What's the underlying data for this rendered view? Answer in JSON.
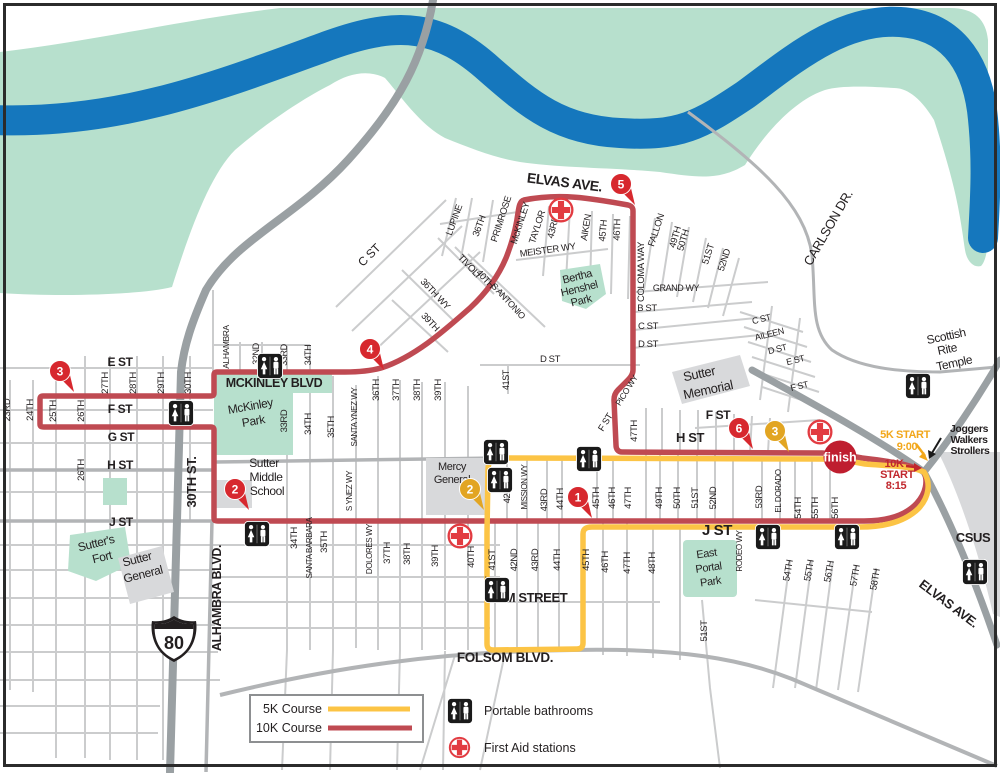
{
  "colors": {
    "river": "#1577bd",
    "riverbank": "#b7e0cd",
    "park": "#b7e0cd",
    "freeway": "#9aa0a3",
    "street": "#cbcccd",
    "street_medium": "#b2b4b6",
    "building": "#d8d9db",
    "course_5k": "#fcc445",
    "course_10k": "#bf4a52",
    "pin_red": "#d7282e",
    "pin_yellow": "#e2a522",
    "first_aid": "#e23b41",
    "finish_bg": "#bf1e2f",
    "start_5k_text": "#f2a71b",
    "start_10k_text": "#c1272d",
    "label": "#231f20"
  },
  "legend": {
    "course_5k": "5K Course",
    "course_10k": "10K Course",
    "bathrooms": "Portable bathrooms",
    "first_aid": "First Aid stations"
  },
  "finish": {
    "label": "finish"
  },
  "shield": {
    "number": "80"
  },
  "pins": [
    {
      "n": "1",
      "x": 578,
      "y": 497,
      "color": "red"
    },
    {
      "n": "2",
      "x": 235,
      "y": 489,
      "color": "red"
    },
    {
      "n": "3",
      "x": 60,
      "y": 371,
      "color": "red"
    },
    {
      "n": "4",
      "x": 370,
      "y": 349,
      "color": "red"
    },
    {
      "n": "5",
      "x": 621,
      "y": 184,
      "color": "red"
    },
    {
      "n": "6",
      "x": 739,
      "y": 428,
      "color": "red"
    },
    {
      "n": "2",
      "x": 470,
      "y": 489,
      "color": "yellow"
    },
    {
      "n": "3",
      "x": 775,
      "y": 431,
      "color": "yellow"
    }
  ],
  "restrooms": [
    {
      "x": 270,
      "y": 366
    },
    {
      "x": 181,
      "y": 413
    },
    {
      "x": 257,
      "y": 534
    },
    {
      "x": 496,
      "y": 452
    },
    {
      "x": 500,
      "y": 480
    },
    {
      "x": 589,
      "y": 459
    },
    {
      "x": 497,
      "y": 590
    },
    {
      "x": 768,
      "y": 537
    },
    {
      "x": 847,
      "y": 537
    },
    {
      "x": 918,
      "y": 386
    },
    {
      "x": 975,
      "y": 572
    }
  ],
  "first_aid_stations": [
    {
      "x": 561,
      "y": 210
    },
    {
      "x": 460,
      "y": 536
    },
    {
      "x": 820,
      "y": 432
    }
  ],
  "map_labels": [
    {
      "t": "ELVAS AVE.",
      "x": 564,
      "y": 187,
      "r": 7,
      "s": 14,
      "w": "bold",
      "n": "elvas-ave-label"
    },
    {
      "t": "CARLSON DR.",
      "x": 832,
      "y": 230,
      "r": -60,
      "s": 13,
      "n": "carlson-dr-label"
    },
    {
      "t": "Scottish",
      "x": 947,
      "y": 340,
      "r": -12,
      "s": 12,
      "n": "scottish-rite-label"
    },
    {
      "t": "Rite",
      "x": 948,
      "y": 353,
      "r": -12,
      "s": 12,
      "n": "scottish-rite-label"
    },
    {
      "t": "Temple",
      "x": 955,
      "y": 367,
      "r": -12,
      "s": 12,
      "n": "scottish-rite-label"
    },
    {
      "t": "Joggers",
      "x": 969,
      "y": 432,
      "s": 10.5,
      "w": "bold",
      "n": "joggers-note"
    },
    {
      "t": "Walkers",
      "x": 969,
      "y": 443,
      "s": 10.5,
      "w": "bold",
      "n": "joggers-note"
    },
    {
      "t": "Strollers",
      "x": 970,
      "y": 454,
      "s": 10.5,
      "w": "bold",
      "n": "joggers-note"
    },
    {
      "t": "5K START",
      "x": 905,
      "y": 438,
      "s": 11,
      "w": "bold",
      "c": "#f2a71b",
      "n": "start-5k-label"
    },
    {
      "t": "9:00",
      "x": 907,
      "y": 450,
      "s": 11,
      "w": "bold",
      "c": "#f2a71b",
      "n": "start-5k-time"
    },
    {
      "t": "10K",
      "x": 894,
      "y": 467,
      "s": 11,
      "w": "bold",
      "c": "#c1272d",
      "n": "start-10k-label"
    },
    {
      "t": "START",
      "x": 897,
      "y": 478,
      "s": 11,
      "w": "bold",
      "c": "#c1272d",
      "n": "start-10k-label"
    },
    {
      "t": "8:15",
      "x": 896,
      "y": 489,
      "s": 11,
      "w": "bold",
      "c": "#c1272d",
      "n": "start-10k-time"
    },
    {
      "t": "CSUS",
      "x": 973,
      "y": 542,
      "s": 13,
      "w": "bold",
      "n": "csus-label"
    },
    {
      "t": "ELVAS AVE.",
      "x": 946,
      "y": 607,
      "r": 37,
      "s": 13,
      "w": "bold",
      "n": "elvas-ave-label"
    },
    {
      "t": "E ST",
      "x": 120,
      "y": 366,
      "s": 12,
      "w": "bold"
    },
    {
      "t": "F ST",
      "x": 120,
      "y": 413,
      "s": 12,
      "w": "bold"
    },
    {
      "t": "G ST",
      "x": 121,
      "y": 441,
      "s": 12,
      "w": "bold"
    },
    {
      "t": "H ST",
      "x": 120,
      "y": 469,
      "s": 12,
      "w": "bold"
    },
    {
      "t": "J ST",
      "x": 121,
      "y": 526,
      "s": 12,
      "w": "bold"
    },
    {
      "t": "23RD",
      "x": 10,
      "y": 410,
      "r": -90,
      "s": 9.5
    },
    {
      "t": "24TH",
      "x": 33,
      "y": 410,
      "r": -90,
      "s": 9.5
    },
    {
      "t": "25TH",
      "x": 56,
      "y": 411,
      "r": -90,
      "s": 9.5
    },
    {
      "t": "26TH",
      "x": 84,
      "y": 411,
      "r": -90,
      "s": 9.5
    },
    {
      "t": "27TH",
      "x": 108,
      "y": 383,
      "r": -90,
      "s": 9.5
    },
    {
      "t": "28TH",
      "x": 136,
      "y": 383,
      "r": -90,
      "s": 9.5
    },
    {
      "t": "29TH",
      "x": 164,
      "y": 383,
      "r": -90,
      "s": 9.5
    },
    {
      "t": "30TH",
      "x": 191,
      "y": 383,
      "r": -90,
      "s": 9.5
    },
    {
      "t": "26TH",
      "x": 84,
      "y": 470,
      "r": -90,
      "s": 9.5
    },
    {
      "t": "30TH ST.",
      "x": 196,
      "y": 482,
      "r": -90,
      "s": 13,
      "w": "bold"
    },
    {
      "t": "ALHAMBRA BLVD.",
      "x": 221,
      "y": 598,
      "r": -90,
      "s": 12.5,
      "w": "bold"
    },
    {
      "t": "ALHAMBRA",
      "x": 229,
      "y": 347,
      "r": -90,
      "s": 8.5
    },
    {
      "t": "Sutter's",
      "x": 97,
      "y": 547,
      "r": -14,
      "s": 12,
      "n": "sutters-fort-label"
    },
    {
      "t": "Fort",
      "x": 103,
      "y": 561,
      "r": -14,
      "s": 12,
      "n": "sutters-fort-label"
    },
    {
      "t": "Sutter",
      "x": 138,
      "y": 563,
      "r": -14,
      "s": 12,
      "n": "sutter-general-label"
    },
    {
      "t": "General",
      "x": 144,
      "y": 578,
      "r": -14,
      "s": 12,
      "n": "sutter-general-label"
    },
    {
      "t": "MCKINLEY BLVD",
      "x": 274,
      "y": 387,
      "s": 12.5,
      "w": "bold",
      "n": "mckinley-blvd-label"
    },
    {
      "t": "McKinley",
      "x": 251,
      "y": 410,
      "r": -10,
      "s": 12,
      "n": "mckinley-park-label"
    },
    {
      "t": "Park",
      "x": 254,
      "y": 425,
      "r": -10,
      "s": 12,
      "n": "mckinley-park-label"
    },
    {
      "t": "Sutter",
      "x": 264,
      "y": 467,
      "s": 12,
      "n": "sutter-middle-label"
    },
    {
      "t": "Middle",
      "x": 266,
      "y": 481,
      "s": 12,
      "n": "sutter-middle-label"
    },
    {
      "t": "School",
      "x": 267,
      "y": 495,
      "s": 12,
      "n": "sutter-middle-label"
    },
    {
      "t": "32ND",
      "x": 259,
      "y": 354,
      "r": -90,
      "s": 9
    },
    {
      "t": "33RD",
      "x": 287,
      "y": 355,
      "r": -90,
      "s": 9
    },
    {
      "t": "34TH",
      "x": 311,
      "y": 355,
      "r": -90,
      "s": 9
    },
    {
      "t": "33RD",
      "x": 287,
      "y": 421,
      "r": -90,
      "s": 9.5
    },
    {
      "t": "34TH",
      "x": 311,
      "y": 424,
      "r": -90,
      "s": 9.5
    },
    {
      "t": "35TH",
      "x": 334,
      "y": 427,
      "r": -90,
      "s": 9.5
    },
    {
      "t": "SANTA YNEZ WY",
      "x": 357,
      "y": 417,
      "r": -90,
      "s": 8
    },
    {
      "t": "36TH",
      "x": 379,
      "y": 390,
      "r": -90,
      "s": 9.5
    },
    {
      "t": "37TH",
      "x": 399,
      "y": 390,
      "r": -90,
      "s": 9.5
    },
    {
      "t": "38TH",
      "x": 420,
      "y": 390,
      "r": -90,
      "s": 9.5
    },
    {
      "t": "39TH",
      "x": 441,
      "y": 390,
      "r": -90,
      "s": 9.5
    },
    {
      "t": "S YNEZ WY",
      "x": 352,
      "y": 491,
      "r": -90,
      "s": 8
    },
    {
      "t": "34TH",
      "x": 297,
      "y": 538,
      "r": -90,
      "s": 9.5
    },
    {
      "t": "SANTA BARBARA",
      "x": 312,
      "y": 548,
      "r": -90,
      "s": 8
    },
    {
      "t": "35TH",
      "x": 327,
      "y": 542,
      "r": -90,
      "s": 9.5
    },
    {
      "t": "DOLORES WY",
      "x": 372,
      "y": 549,
      "r": -90,
      "s": 8
    },
    {
      "t": "37TH",
      "x": 390,
      "y": 553,
      "r": -90,
      "s": 9.5
    },
    {
      "t": "38TH",
      "x": 410,
      "y": 554,
      "r": -90,
      "s": 9.5
    },
    {
      "t": "39TH",
      "x": 438,
      "y": 556,
      "r": -90,
      "s": 9.5
    },
    {
      "t": "40TH",
      "x": 474,
      "y": 557,
      "r": -90,
      "s": 9.5
    },
    {
      "t": "41ST",
      "x": 492,
      "y": 587,
      "r": -90,
      "s": 9.5
    },
    {
      "t": "Mercy",
      "x": 452,
      "y": 470,
      "s": 11,
      "n": "mercy-general-label"
    },
    {
      "t": "General",
      "x": 452,
      "y": 483,
      "s": 11,
      "n": "mercy-general-label"
    },
    {
      "t": "M STREET",
      "x": 536,
      "y": 602,
      "s": 13,
      "w": "bold",
      "n": "m-street-label"
    },
    {
      "t": "FOLSOM BLVD.",
      "x": 505,
      "y": 662,
      "s": 13.5,
      "w": "bold",
      "n": "folsom-blvd-label"
    },
    {
      "t": "42ND",
      "x": 510,
      "y": 492,
      "r": -90,
      "s": 9.5
    },
    {
      "t": "MISSION WY",
      "x": 527,
      "y": 487,
      "r": -90,
      "s": 8
    },
    {
      "t": "43RD",
      "x": 547,
      "y": 500,
      "r": -90,
      "s": 9.5
    },
    {
      "t": "44TH",
      "x": 563,
      "y": 499,
      "r": -90,
      "s": 9.5
    },
    {
      "t": "45TH",
      "x": 599,
      "y": 498,
      "r": -90,
      "s": 9.5
    },
    {
      "t": "46TH",
      "x": 615,
      "y": 498,
      "r": -90,
      "s": 9.5
    },
    {
      "t": "47TH",
      "x": 631,
      "y": 498,
      "r": -90,
      "s": 9.5
    },
    {
      "t": "49TH",
      "x": 662,
      "y": 498,
      "r": -90,
      "s": 9.5
    },
    {
      "t": "50TH",
      "x": 680,
      "y": 498,
      "r": -90,
      "s": 9.5
    },
    {
      "t": "51ST",
      "x": 698,
      "y": 498,
      "r": -90,
      "s": 9.5
    },
    {
      "t": "52ND",
      "x": 716,
      "y": 498,
      "r": -90,
      "s": 9.5
    },
    {
      "t": "53RD",
      "x": 762,
      "y": 497,
      "r": -90,
      "s": 9.5
    },
    {
      "t": "EL DORADO",
      "x": 781,
      "y": 491,
      "r": -90,
      "s": 8
    },
    {
      "t": "54TH",
      "x": 801,
      "y": 508,
      "r": -90,
      "s": 9.5
    },
    {
      "t": "55TH",
      "x": 818,
      "y": 508,
      "r": -90,
      "s": 9.5
    },
    {
      "t": "56TH",
      "x": 838,
      "y": 508,
      "r": -90,
      "s": 9.5
    },
    {
      "t": "41ST",
      "x": 495,
      "y": 560,
      "r": -90,
      "s": 9.5
    },
    {
      "t": "42ND",
      "x": 517,
      "y": 560,
      "r": -90,
      "s": 9.5
    },
    {
      "t": "43RD",
      "x": 538,
      "y": 560,
      "r": -90,
      "s": 9.5
    },
    {
      "t": "44TH",
      "x": 560,
      "y": 560,
      "r": -90,
      "s": 9.5
    },
    {
      "t": "45TH",
      "x": 589,
      "y": 560,
      "r": -90,
      "s": 9.5
    },
    {
      "t": "46TH",
      "x": 608,
      "y": 562,
      "r": -90,
      "s": 9.5
    },
    {
      "t": "47TH",
      "x": 630,
      "y": 563,
      "r": -90,
      "s": 9.5
    },
    {
      "t": "48TH",
      "x": 655,
      "y": 563,
      "r": -90,
      "s": 9.5
    },
    {
      "t": "J ST",
      "x": 717,
      "y": 535,
      "s": 15,
      "w": "bold"
    },
    {
      "t": "East",
      "x": 707,
      "y": 557,
      "r": -8,
      "s": 11,
      "n": "east-portal-label"
    },
    {
      "t": "Portal",
      "x": 709,
      "y": 571,
      "r": -8,
      "s": 11,
      "n": "east-portal-label"
    },
    {
      "t": "Park",
      "x": 711,
      "y": 585,
      "r": -8,
      "s": 11,
      "n": "east-portal-label"
    },
    {
      "t": "RODEO WY",
      "x": 742,
      "y": 551,
      "r": -90,
      "s": 8
    },
    {
      "t": "51ST",
      "x": 707,
      "y": 631,
      "r": -90,
      "s": 9.5
    },
    {
      "t": "54TH",
      "x": 791,
      "y": 571,
      "r": -80,
      "s": 9.5
    },
    {
      "t": "55TH",
      "x": 812,
      "y": 571,
      "r": -80,
      "s": 9.5
    },
    {
      "t": "56TH",
      "x": 832,
      "y": 572,
      "r": -80,
      "s": 9.5
    },
    {
      "t": "57TH",
      "x": 858,
      "y": 576,
      "r": -80,
      "s": 9.5
    },
    {
      "t": "58TH",
      "x": 878,
      "y": 580,
      "r": -80,
      "s": 9.5
    },
    {
      "t": "H ST",
      "x": 690,
      "y": 442,
      "s": 13,
      "w": "bold"
    },
    {
      "t": "F ST",
      "x": 718,
      "y": 419,
      "s": 12,
      "w": "bold"
    },
    {
      "t": "47TH",
      "x": 637,
      "y": 431,
      "r": -90,
      "s": 9.5
    },
    {
      "t": "PICO WY",
      "x": 629,
      "y": 392,
      "r": -58,
      "s": 8.5
    },
    {
      "t": "F ST",
      "x": 608,
      "y": 424,
      "r": -58,
      "s": 9.5
    },
    {
      "t": "Sutter",
      "x": 700,
      "y": 378,
      "r": -12,
      "s": 13,
      "n": "sutter-memorial-label"
    },
    {
      "t": "Memorial",
      "x": 709,
      "y": 394,
      "r": -12,
      "s": 13,
      "n": "sutter-memorial-label"
    },
    {
      "t": "D ST",
      "x": 550,
      "y": 362,
      "s": 9.5
    },
    {
      "t": "41ST",
      "x": 509,
      "y": 380,
      "r": -90,
      "s": 9
    },
    {
      "t": "D ST",
      "x": 648,
      "y": 347,
      "s": 9.5
    },
    {
      "t": "C ST",
      "x": 648,
      "y": 329,
      "s": 9.5
    },
    {
      "t": "B ST",
      "x": 647,
      "y": 311,
      "s": 9.5
    },
    {
      "t": "GRAND WY",
      "x": 676,
      "y": 291,
      "s": 9
    },
    {
      "t": "COLOMA WAY",
      "x": 644,
      "y": 272,
      "r": -90,
      "s": 9.5
    },
    {
      "t": "FALLON",
      "x": 659,
      "y": 231,
      "r": -72,
      "s": 9.5
    },
    {
      "t": "49TH",
      "x": 678,
      "y": 238,
      "r": -74,
      "s": 9.5
    },
    {
      "t": "50TH",
      "x": 686,
      "y": 241,
      "r": -74,
      "s": 9.5
    },
    {
      "t": "51ST",
      "x": 711,
      "y": 255,
      "r": -72,
      "s": 9.5
    },
    {
      "t": "52ND",
      "x": 727,
      "y": 261,
      "r": -72,
      "s": 9.5
    },
    {
      "t": "C ST",
      "x": 762,
      "y": 322,
      "r": -14,
      "s": 9
    },
    {
      "t": "AILEEN",
      "x": 770,
      "y": 337,
      "r": -14,
      "s": 9
    },
    {
      "t": "D ST",
      "x": 778,
      "y": 352,
      "r": -14,
      "s": 9
    },
    {
      "t": "E ST",
      "x": 796,
      "y": 363,
      "r": -14,
      "s": 9
    },
    {
      "t": "F ST",
      "x": 800,
      "y": 389,
      "r": -14,
      "s": 9
    },
    {
      "t": "C ST",
      "x": 372,
      "y": 258,
      "r": -45,
      "s": 12
    },
    {
      "t": "LUPINE",
      "x": 457,
      "y": 221,
      "r": -70,
      "s": 9.5
    },
    {
      "t": "36TH",
      "x": 482,
      "y": 227,
      "r": -70,
      "s": 9.5
    },
    {
      "t": "PRIMROSE",
      "x": 504,
      "y": 220,
      "r": -72,
      "s": 9.5
    },
    {
      "t": "McKINLEY",
      "x": 523,
      "y": 224,
      "r": -72,
      "s": 9.5
    },
    {
      "t": "TAYLOR",
      "x": 540,
      "y": 228,
      "r": -72,
      "s": 9.5
    },
    {
      "t": "43RD",
      "x": 556,
      "y": 228,
      "r": -75,
      "s": 9.5
    },
    {
      "t": "AIKEN",
      "x": 589,
      "y": 228,
      "r": -80,
      "s": 9.5
    },
    {
      "t": "45TH",
      "x": 606,
      "y": 231,
      "r": -85,
      "s": 9.5
    },
    {
      "t": "46TH",
      "x": 620,
      "y": 230,
      "r": -88,
      "s": 9.5
    },
    {
      "t": "MEISTER WY",
      "x": 548,
      "y": 253,
      "r": -8,
      "s": 9.5
    },
    {
      "t": "Bertha",
      "x": 578,
      "y": 280,
      "r": -14,
      "s": 11,
      "n": "bertha-henshel-label"
    },
    {
      "t": "Henshel",
      "x": 580,
      "y": 292,
      "r": -14,
      "s": 11,
      "n": "bertha-henshel-label"
    },
    {
      "t": "Park",
      "x": 582,
      "y": 304,
      "r": -14,
      "s": 11,
      "n": "bertha-henshel-label"
    },
    {
      "t": "TIVOLI",
      "x": 467,
      "y": 268,
      "r": 47,
      "s": 9.5
    },
    {
      "t": "40TH",
      "x": 483,
      "y": 281,
      "r": 47,
      "s": 9.5
    },
    {
      "t": "S ANTONIO",
      "x": 506,
      "y": 303,
      "r": 47,
      "s": 9
    },
    {
      "t": "36TH WY",
      "x": 433,
      "y": 296,
      "r": 47,
      "s": 9.5
    },
    {
      "t": "39TH",
      "x": 428,
      "y": 324,
      "r": 47,
      "s": 9.5
    }
  ]
}
